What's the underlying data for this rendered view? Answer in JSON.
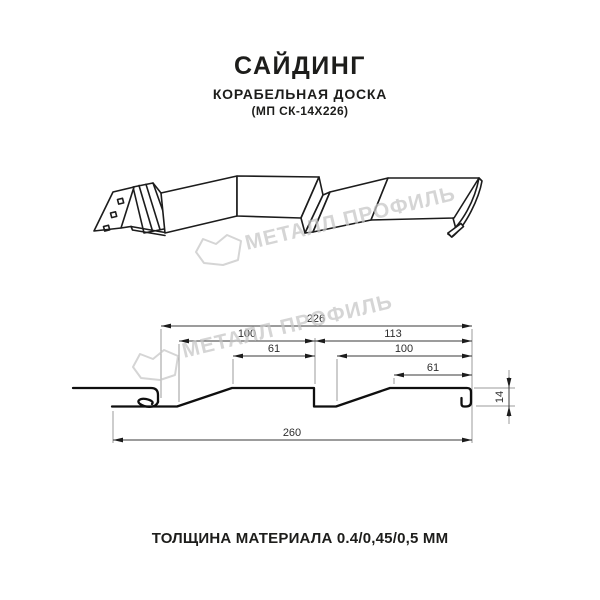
{
  "header": {
    "title": "САЙДИНГ",
    "subtitle": "КОРАБЕЛЬНАЯ ДОСКА",
    "model": "(МП СК-14Х226)"
  },
  "watermark": {
    "brand": "МЕТАЛЛ ПРОФИЛЬ"
  },
  "drawing": {
    "type": "siding-profile-technical-drawing",
    "dimensions": {
      "coverage_width": "226",
      "left_panel_width": "100",
      "left_panel_flat": "61",
      "right_section_width": "113",
      "right_panel_width": "100",
      "right_panel_flat": "61",
      "profile_height": "14",
      "total_width": "260"
    }
  },
  "footer": {
    "thickness_label": "ТОЛЩИНА МАТЕРИАЛА 0.4/0,45/0,5 ММ"
  },
  "colors": {
    "line": "#1c1c1c",
    "dimension_line": "#3a3a3a",
    "extension_line": "#9b9b9b",
    "watermark": "#c6c6c6",
    "background": "#ffffff"
  }
}
